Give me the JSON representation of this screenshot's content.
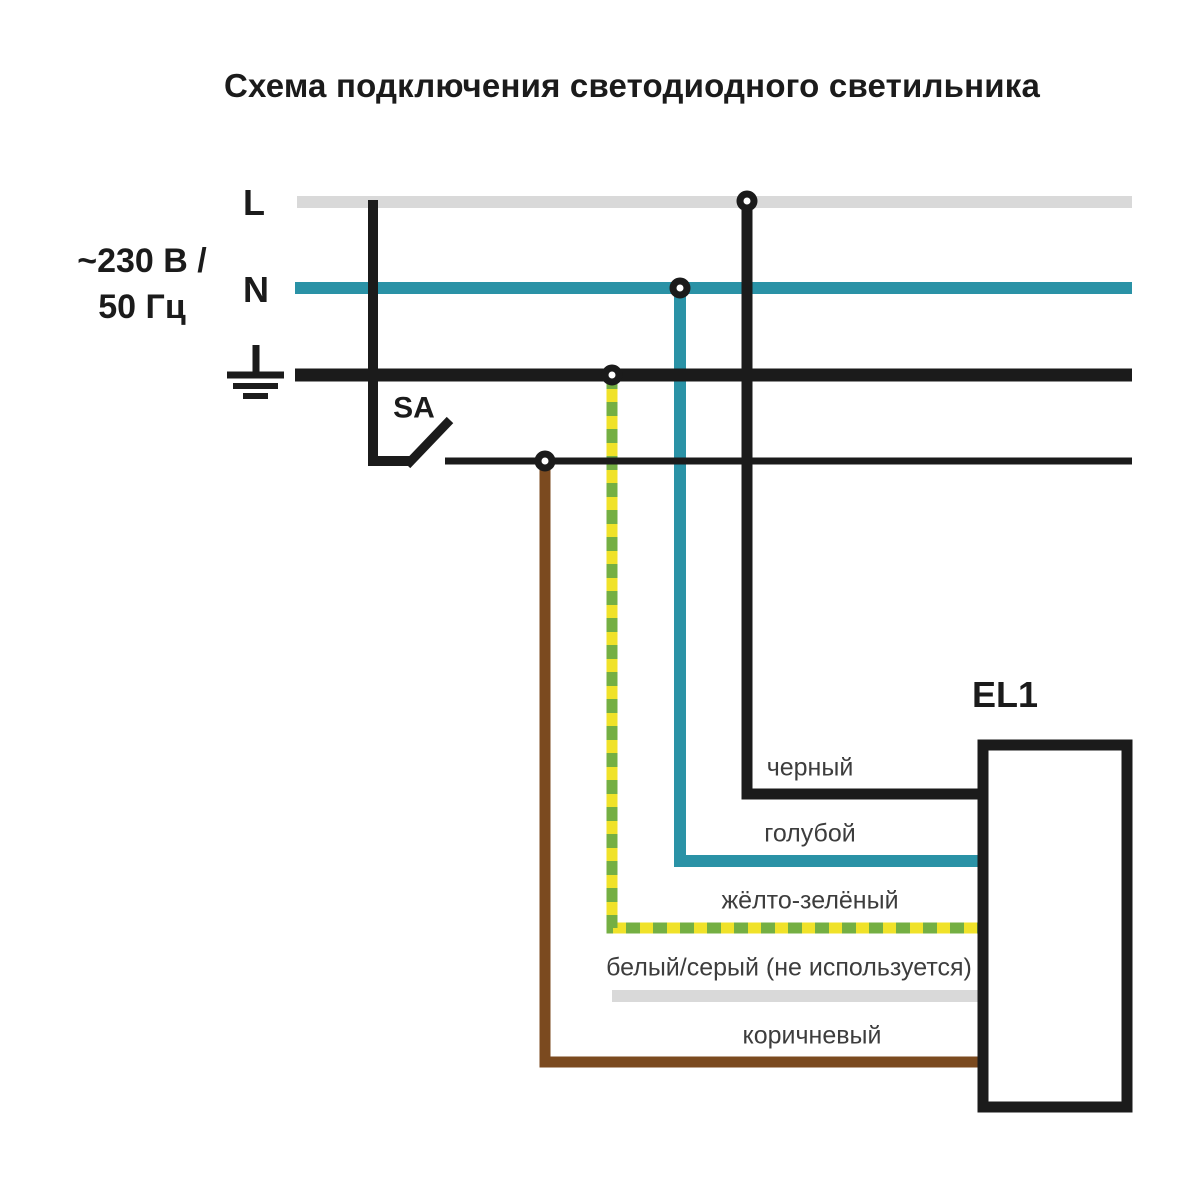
{
  "title": "Схема подключения светодиодного светильника",
  "power_source": {
    "voltage": "~230 В /",
    "frequency": "50 Гц",
    "line_label": "L",
    "neutral_label": "N"
  },
  "switch_label": "SA",
  "luminaire_label": "EL1",
  "wires": [
    {
      "id": "black",
      "label": "черный",
      "color": "#1b1b1b"
    },
    {
      "id": "blue",
      "label": "голубой",
      "color": "#2a92a6"
    },
    {
      "id": "yellow-green",
      "label": "жёлто-зелёный",
      "color_yellow": "#f0e229",
      "color_green": "#74af43"
    },
    {
      "id": "white-gray",
      "label": "белый/серый (не используется)",
      "color": "#d9d9d9"
    },
    {
      "id": "brown",
      "label": "коричневый",
      "color": "#7b4a1f"
    }
  ],
  "colors": {
    "black_line": "#1b1b1b",
    "gray_line": "#d9d9d9",
    "teal_line": "#2a92a6",
    "yellow": "#f0e229",
    "green": "#74af43",
    "brown": "#7b4a1f",
    "box_fill": "#ffffff",
    "dot_fill": "#ffffff",
    "label_text": "#3d3d3d",
    "bold_text": "#1b1b1b"
  }
}
